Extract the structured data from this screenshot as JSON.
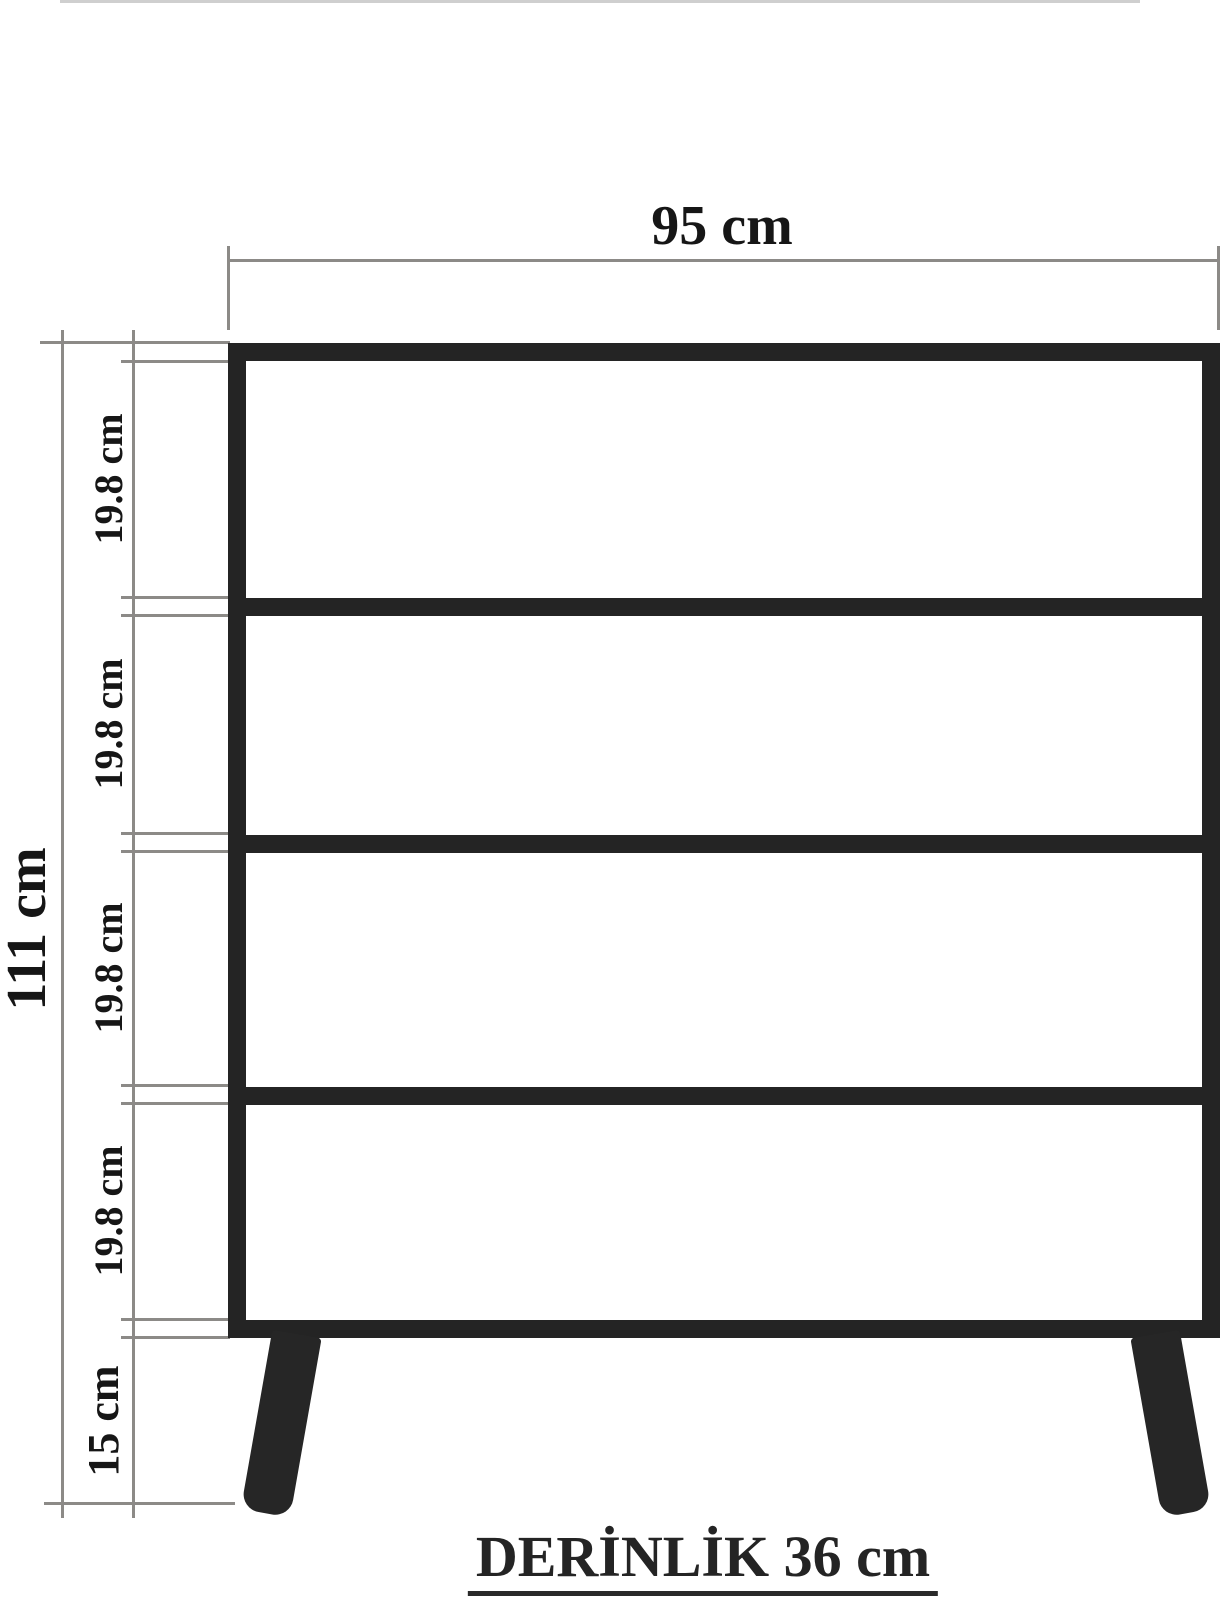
{
  "diagram": {
    "type": "furniture-dimension-drawing",
    "product": "4-drawer chest",
    "dimensions": {
      "width_label": "95 cm",
      "total_height_label": "111 cm",
      "drawer_section_labels": [
        "19.8 cm",
        "19.8 cm",
        "19.8 cm",
        "19.8 cm"
      ],
      "leg_height_label": "15 cm",
      "depth_label": "DERİNLİK 36 cm"
    },
    "colors": {
      "cabinet_outline": "#242424",
      "dimension_lines": "#8c8a87",
      "label_text": "#161616",
      "background": "#ffffff"
    }
  }
}
